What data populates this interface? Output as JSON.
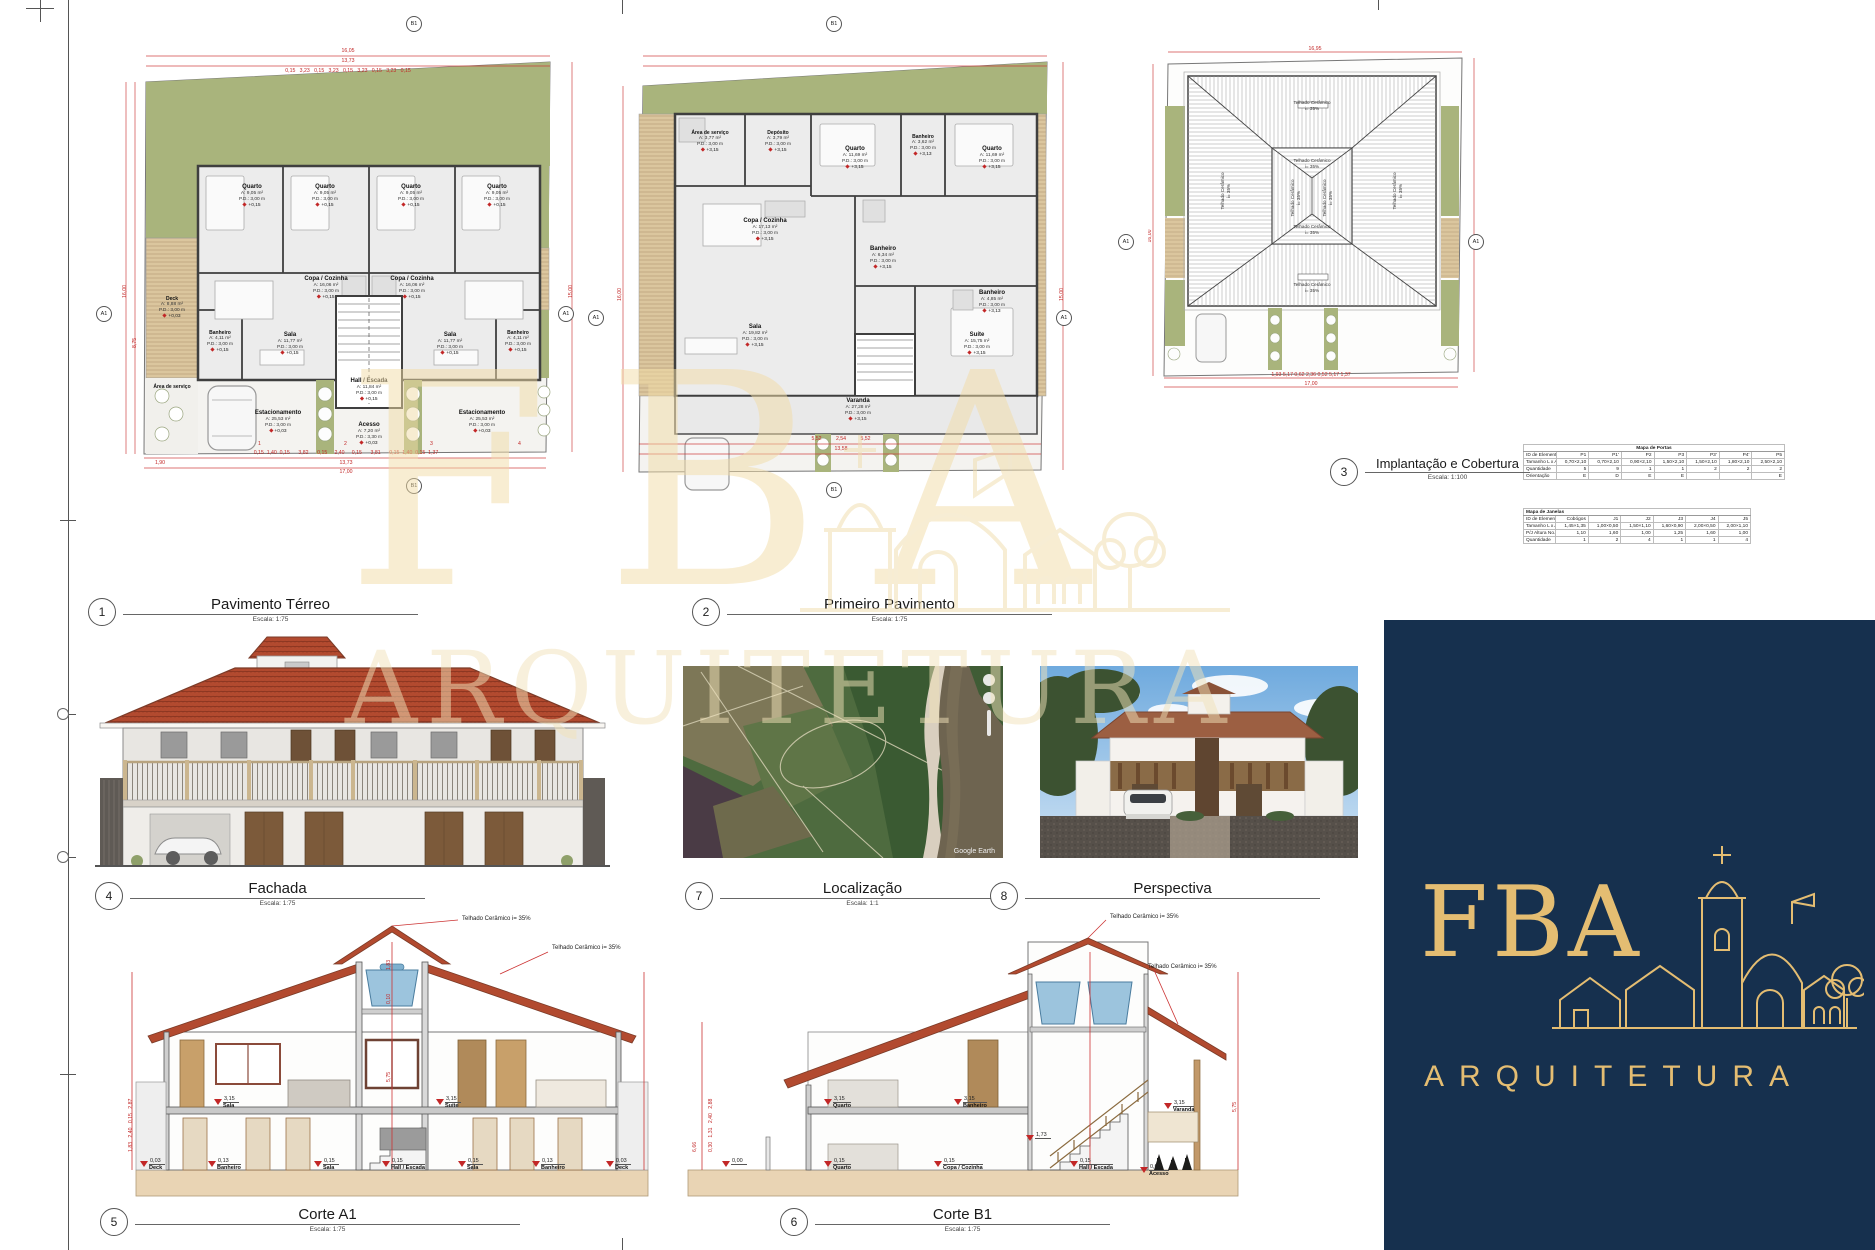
{
  "titles": {
    "t1": {
      "num": "1",
      "label": "Pavimento Térreo",
      "scale": "Escala: 1:75"
    },
    "t2": {
      "num": "2",
      "label": "Primeiro Pavimento",
      "scale": "Escala: 1:75"
    },
    "t3": {
      "num": "3",
      "label": "Implantação e Cobertura",
      "scale": "Escala: 1:100"
    },
    "t4": {
      "num": "4",
      "label": "Fachada",
      "scale": "Escala: 1:75"
    },
    "t7": {
      "num": "7",
      "label": "Localização",
      "scale": "Escala: 1:1"
    },
    "t8": {
      "num": "8",
      "label": "Perspectiva",
      "scale": ""
    },
    "t5": {
      "num": "5",
      "label": "Corte A1",
      "scale": "Escala: 1:75"
    },
    "t6": {
      "num": "6",
      "label": "Corte B1",
      "scale": "Escala: 1:75"
    }
  },
  "markers": {
    "a1": "A1",
    "b1": "B1"
  },
  "plan_terreo": {
    "rooms": {
      "quarto": {
        "name": "Quarto",
        "area": "A:  9,05 m²",
        "pd": "P.D.:  3,00 m",
        "lvl": "+0,15"
      },
      "copa": {
        "name": "Copa / Cozinha",
        "area": "A:  16,06 m²",
        "pd": "P.D.:  3,00 m",
        "lvl": "+0,15"
      },
      "sala": {
        "name": "Sala",
        "area": "A:  11,77 m²",
        "pd": "P.D.:  3,00 m",
        "lvl": "+0,15"
      },
      "banheiro": {
        "name": "Banheiro",
        "area": "A:  4,11 m²",
        "pd": "P.D.:  3,00 m",
        "lvl": "+0,15"
      },
      "deck": {
        "name": "Deck",
        "area": "A:  8,88 m²",
        "pd": "P.D.:  3,00 m",
        "lvl": "+0,03"
      },
      "hall": {
        "name": "Hall / Escada",
        "area": "A:  11,84 m²",
        "pd": "P.D.:  3,00 m",
        "lvl": "+0,15"
      },
      "estacionamento": {
        "name": "Estacionamento",
        "area": "A:  25,53 m²",
        "pd": "P.D.:  3,00 m",
        "lvl": "+0,03"
      },
      "acesso": {
        "name": "Acesso",
        "area": "A:  7,20 m²",
        "pd": "P.D.:  3,30 m",
        "lvl": "+0,03"
      },
      "area_servico": {
        "name": "Área de serviço"
      }
    },
    "dims": {
      "top_total": "16,05",
      "top_sub": "13,73",
      "top_segs": "0,15   3,23   0,15   3,23   0,15   3,23   0,15   3,23   0,15",
      "bottom_segs": "0,15  1,40  0,15      3,82      0,15     2,40     0,15      3,81      0,15  1,40  0,15  1,37",
      "bottom_left": "1,90",
      "bottom_sub": "13,73",
      "bottom_total": "17,00",
      "left_total": "16,00",
      "left_sub": "8,75",
      "right_total": "15,00",
      "stalls": [
        "1",
        "2",
        "3",
        "4"
      ]
    }
  },
  "plan_primeiro": {
    "rooms": {
      "area_servico": {
        "name": "Área de serviço",
        "area": "A:  3,77 m²",
        "pd": "P.D.:  3,00 m",
        "lvl": "+3,15"
      },
      "deposito": {
        "name": "Depósito",
        "area": "A:  3,79 m²",
        "pd": "P.D.:  3,00 m",
        "lvl": "+3,15"
      },
      "quarto": {
        "name": "Quarto",
        "area": "A:  11,69 m²",
        "pd": "P.D.:  3,00 m",
        "lvl": "+3,15"
      },
      "banheiro_sm": {
        "name": "Banheiro",
        "area": "A:  3,62 m²",
        "pd": "P.D.:  3,00 m",
        "lvl": "+3,13"
      },
      "copa": {
        "name": "Copa / Cozinha",
        "area": "A:  17,13 m²",
        "pd": "P.D.:  3,00 m",
        "lvl": "+3,15"
      },
      "banheiro_md": {
        "name": "Banheiro",
        "area": "A:  6,34 m²",
        "pd": "P.D.:  3,00 m",
        "lvl": "+3,15"
      },
      "banheiro_su": {
        "name": "Banheiro",
        "area": "A:  4,85 m²",
        "pd": "P.D.:  3,00 m",
        "lvl": "+3,13"
      },
      "sala": {
        "name": "Sala",
        "area": "A:  19,82 m²",
        "pd": "P.D.:  3,00 m",
        "lvl": "+3,15"
      },
      "suite": {
        "name": "Suíte",
        "area": "A:  15,75 m²",
        "pd": "P.D.:  3,00 m",
        "lvl": "+3,15"
      },
      "varanda": {
        "name": "Varanda",
        "area": "A:  27,28 m²",
        "pd": "P.D.:  3,00 m",
        "lvl": "+3,15"
      }
    },
    "dims": {
      "bottom_segs": "5,52          2,54          5,52",
      "bottom_total": "13,58",
      "left_total": "16,00",
      "right_total": "15,00"
    }
  },
  "plan_cobertura": {
    "roof_label1": "Telhado Cerâmico",
    "roof_label2": "i= 35%",
    "dims": {
      "top_total": "16,95",
      "bottom_segs": "1,93    5,17    0,62    2,36    0,52    5,17    1,37",
      "bottom_total": "17,00",
      "left_total": "16,00"
    }
  },
  "tables": {
    "portas": {
      "title": "Mapa de Portas",
      "row_labels": [
        "ID de Elemento",
        "Tamanho L x A",
        "Quantidade",
        "Orientação"
      ],
      "ids": [
        "P1",
        "P1'",
        "P2",
        "P3",
        "P3'",
        "P4'",
        "P5"
      ],
      "tamanho": [
        "0,70×2,10",
        "0,70×2,10",
        "0,90×2,10",
        "1,50×2,10",
        "1,50×2,10",
        "1,80×2,10",
        "2,50×2,10"
      ],
      "quantidade": [
        "5",
        "9",
        "1",
        "1",
        "2",
        "2",
        "2"
      ],
      "orientacao": [
        "E",
        "D",
        "E",
        "E",
        "",
        "",
        "E"
      ]
    },
    "janelas": {
      "title": "Mapa de Janelas",
      "row_labels": [
        "ID de Elemento",
        "Tamanho L x A",
        "P/J Altura No..",
        "Quantidade"
      ],
      "ids": [
        "Cobógos",
        "J1",
        "J2",
        "J3",
        "J4",
        "J5"
      ],
      "tamanho": [
        "1,45×1,35",
        "1,00×0,50",
        "1,50×1,10",
        "1,60×0,90",
        "2,00×0,50",
        "2,00×1,10"
      ],
      "altura": [
        "1,10",
        "1,60",
        "1,00",
        "1,25",
        "1,60",
        "1,00"
      ],
      "quantidade": [
        "1",
        "2",
        "4",
        "1",
        "1",
        "4"
      ]
    }
  },
  "corte_a1": {
    "callout": "Telhado Cerâmico i= 35%",
    "upper": [
      {
        "v": "3,15",
        "l": "Sala"
      },
      {
        "v": "3,15",
        "l": "Suíte"
      }
    ],
    "lower": [
      {
        "v": "0,03",
        "l": "Deck"
      },
      {
        "v": "0,13",
        "l": "Banheiro"
      },
      {
        "v": "0,15",
        "l": "Sala"
      },
      {
        "v": "0,15",
        "l": "Hall / Escada"
      },
      {
        "v": "0,15",
        "l": "Sala"
      },
      {
        "v": "0,13",
        "l": "Banheiro"
      },
      {
        "v": "0,03",
        "l": "Deck"
      }
    ],
    "dims_left": "1,83   2,40   0,15   2,87",
    "dim_center": "5,75",
    "dim_center2": "0,10",
    "dim_center3": "1,83"
  },
  "corte_b1": {
    "callout": "Telhado Cerâmico i= 35%",
    "upper": [
      {
        "v": "3,15",
        "l": "Quarto"
      },
      {
        "v": "3,15",
        "l": "Banheiro"
      },
      {
        "v": "3,15",
        "l": "Varanda"
      }
    ],
    "mid": {
      "v": "1,73",
      "l": ""
    },
    "lower": [
      {
        "v": "0,00",
        "l": ""
      },
      {
        "v": "0,15",
        "l": "Quarto"
      },
      {
        "v": "0,15",
        "l": "Copa / Cozinha"
      },
      {
        "v": "0,15",
        "l": "Hall / Escada"
      },
      {
        "v": "0,00",
        "l": "Acesso"
      }
    ],
    "dims_left_total": "6,66",
    "dims_left": "0,30   1,31   2,40   2,88",
    "dim_center": "5,75"
  },
  "localizacao": {
    "credit": "Google Earth"
  },
  "logo": {
    "fba": "FBA",
    "sub": "ARQUITETURA"
  },
  "watermark": {
    "fba": "FBA",
    "sub": "ARQUITETURA"
  }
}
